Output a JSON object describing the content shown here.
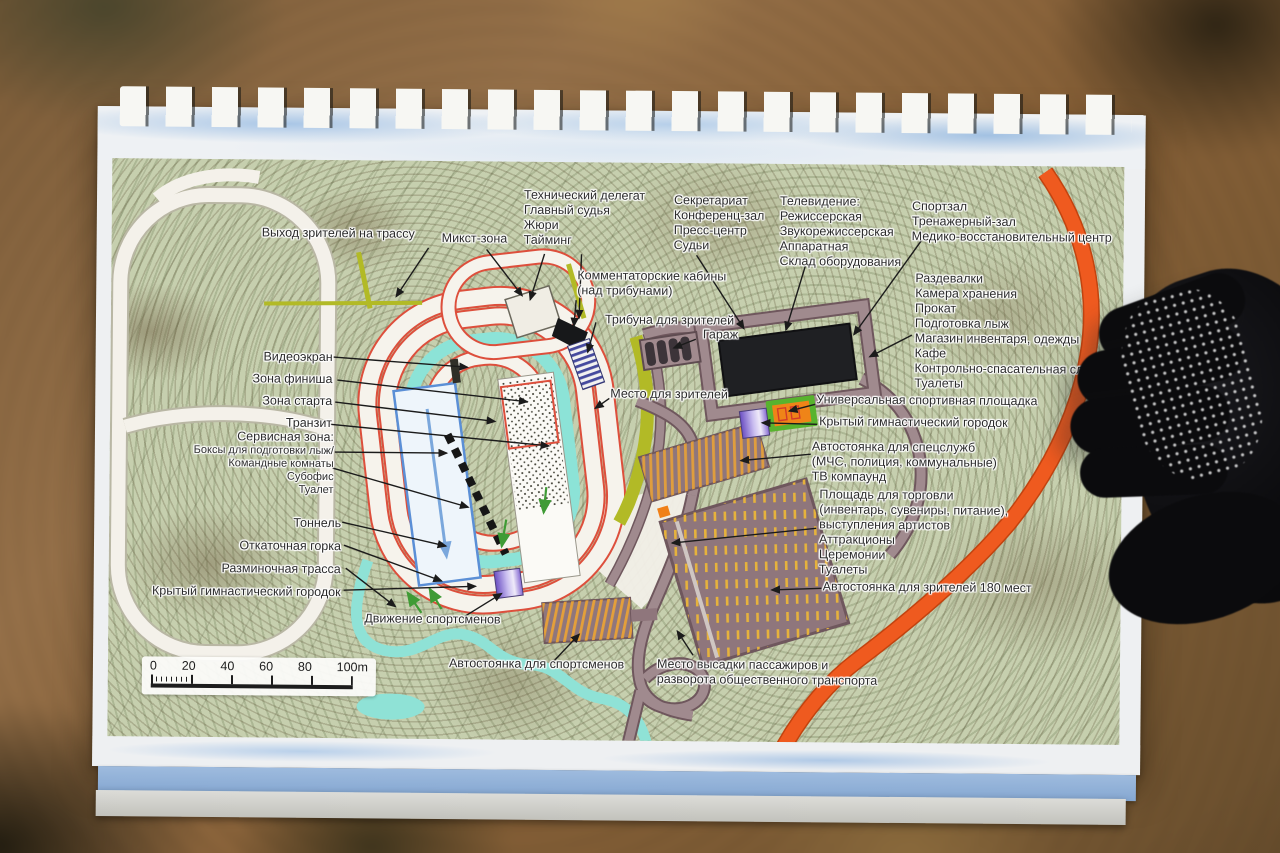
{
  "map": {
    "labels": {
      "exit_spectators": "Выход зрителей на трассу",
      "mixed_zone": "Микст-зона",
      "officials_block": [
        "Технический делегат",
        "Главный судья",
        "Жюри",
        "Тайминг"
      ],
      "secretariat_block": [
        "Секретариат",
        "Конференц-зал",
        "Пресс-центр",
        "Судьи"
      ],
      "tv_block": [
        "Телевидение:",
        "Режиссерская",
        "Звукорежиссерская",
        "Аппаратная",
        "Склад оборудования"
      ],
      "gym_block": [
        "Спортзал",
        "Тренажерный-зал",
        "Медико-восстановительный центр"
      ],
      "commentator_block": [
        "Комментаторские кабины",
        "(над трибунами)"
      ],
      "tribune": "Трибуна для зрителей",
      "garage": "Гараж",
      "services_block": [
        "Раздевалки",
        "Камера хранения",
        "Прокат",
        "Подготовка лыж",
        "Магазин инвентаря, одежды",
        "Кафе",
        "Контрольно-спасательная служба",
        "Туалеты"
      ],
      "video_screen": "Видеоэкран",
      "finish_zone": "Зона финиша",
      "start_zone": "Зона старта",
      "transit": "Транзит",
      "spectator_place": "Место для зрителей",
      "universal_ground": "Универсальная спортивная площадка",
      "covered_gym_right": "Крытый гимнастический городок",
      "service_zone_block": {
        "title": "Сервисная зона:",
        "lines": [
          "Боксы для подготовки лыж/",
          "Командные комнаты",
          "Субофис",
          "Туалет"
        ]
      },
      "special_parking_block": [
        "Автостоянка для спецслужб",
        "(МЧС, полиция, коммунальные)",
        "ТВ компаунд"
      ],
      "trade_square_block": [
        "Площадь для торговли",
        "(инвентарь, сувениры, питание),",
        "выступления артистов",
        "Аттракционы",
        "Церемонии",
        "Туалеты"
      ],
      "tunnel": "Тоннель",
      "rolling_hill": "Откаточная горка",
      "warmup_track": "Разминочная трасса",
      "covered_gym_left": "Крытый гимнастический городок",
      "athletes_movement": "Движение спортсменов",
      "spectator_parking": "Автостоянка для зрителей 180 мест",
      "athletes_parking": "Автостоянка для спортсменов",
      "dropoff_block": [
        "Место высадки пассажиров и",
        "разворота общественного транспорта"
      ]
    },
    "scale": {
      "ticks": [
        "0",
        "20",
        "40",
        "60",
        "80",
        "100m"
      ]
    },
    "colors": {
      "orange_road": "#ef5a1f",
      "track_outline_red": "#dd4f3c",
      "water_cyan": "#8fe2d6",
      "spectator_strip_olive": "#b2ba26",
      "road_mauve": "#a08a8e",
      "parking_marking_yellow": "#e6b23c",
      "building_black": "#1f2023",
      "gym_purple": "#6a4ec2",
      "field_green": "#58b32e",
      "field_orange": "#ef8418",
      "start_rect_blue": "#5b8fd6"
    }
  }
}
